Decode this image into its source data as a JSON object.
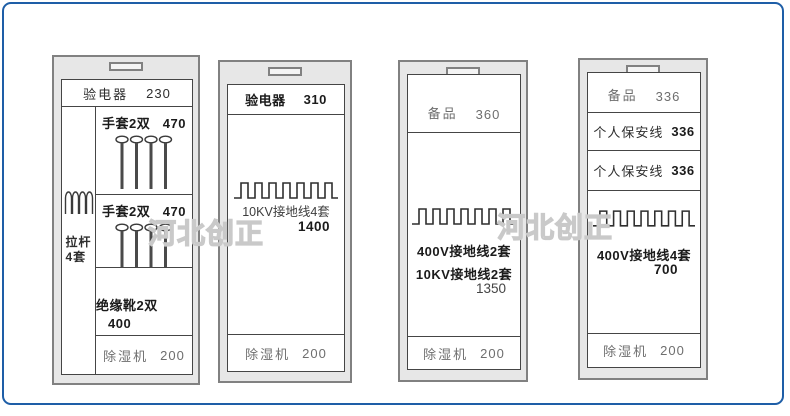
{
  "colors": {
    "frame_border": "#1e5ea7",
    "cabinet_fill": "#e7e7e7",
    "cabinet_border": "#818181",
    "panel_line": "#454545",
    "ink": "#2e2e2e",
    "ink_light": "#6e6e6e",
    "watermark": "#c9c9c9"
  },
  "icons": {
    "coil": "coil-spring-icon",
    "pins": "glove-pin-rack-icon",
    "rail": "hanger-rail-icon"
  },
  "watermarks": {
    "first": "河北创正",
    "second": "河北创正"
  },
  "cabinets": {
    "c1": {
      "header": {
        "label": "验电器",
        "value": "230"
      },
      "left": {
        "line1": "拉杆",
        "line2": "4套"
      },
      "row_gloves1": {
        "label": "手套2双",
        "value": "470"
      },
      "row_gloves2": {
        "label": "手套2双",
        "value": "470"
      },
      "row_boots": {
        "label": "绝缘靴2双",
        "value": "400"
      },
      "row_dehumidifier": {
        "label": "除湿机",
        "value": "200"
      }
    },
    "c2": {
      "header": {
        "label": "验电器",
        "value": "310"
      },
      "middle": {
        "label": "10KV接地线4套",
        "value": "1400"
      },
      "row_dehumidifier": {
        "label": "除湿机",
        "value": "200"
      }
    },
    "c3": {
      "header": {
        "label": "备品",
        "value": "360"
      },
      "middle": {
        "line1": "400V接地线2套",
        "line2": "10KV接地线2套",
        "value": "1350"
      },
      "row_dehumidifier": {
        "label": "除湿机",
        "value": "200"
      }
    },
    "c4": {
      "row_spare": {
        "label": "备品",
        "value": "336"
      },
      "row_personal1": {
        "label": "个人保安线",
        "value": "336"
      },
      "row_personal2": {
        "label": "个人保安线",
        "value": "336"
      },
      "middle": {
        "label": "400V接地线4套",
        "value": "700"
      },
      "row_dehumidifier": {
        "label": "除湿机",
        "value": "200"
      }
    }
  }
}
